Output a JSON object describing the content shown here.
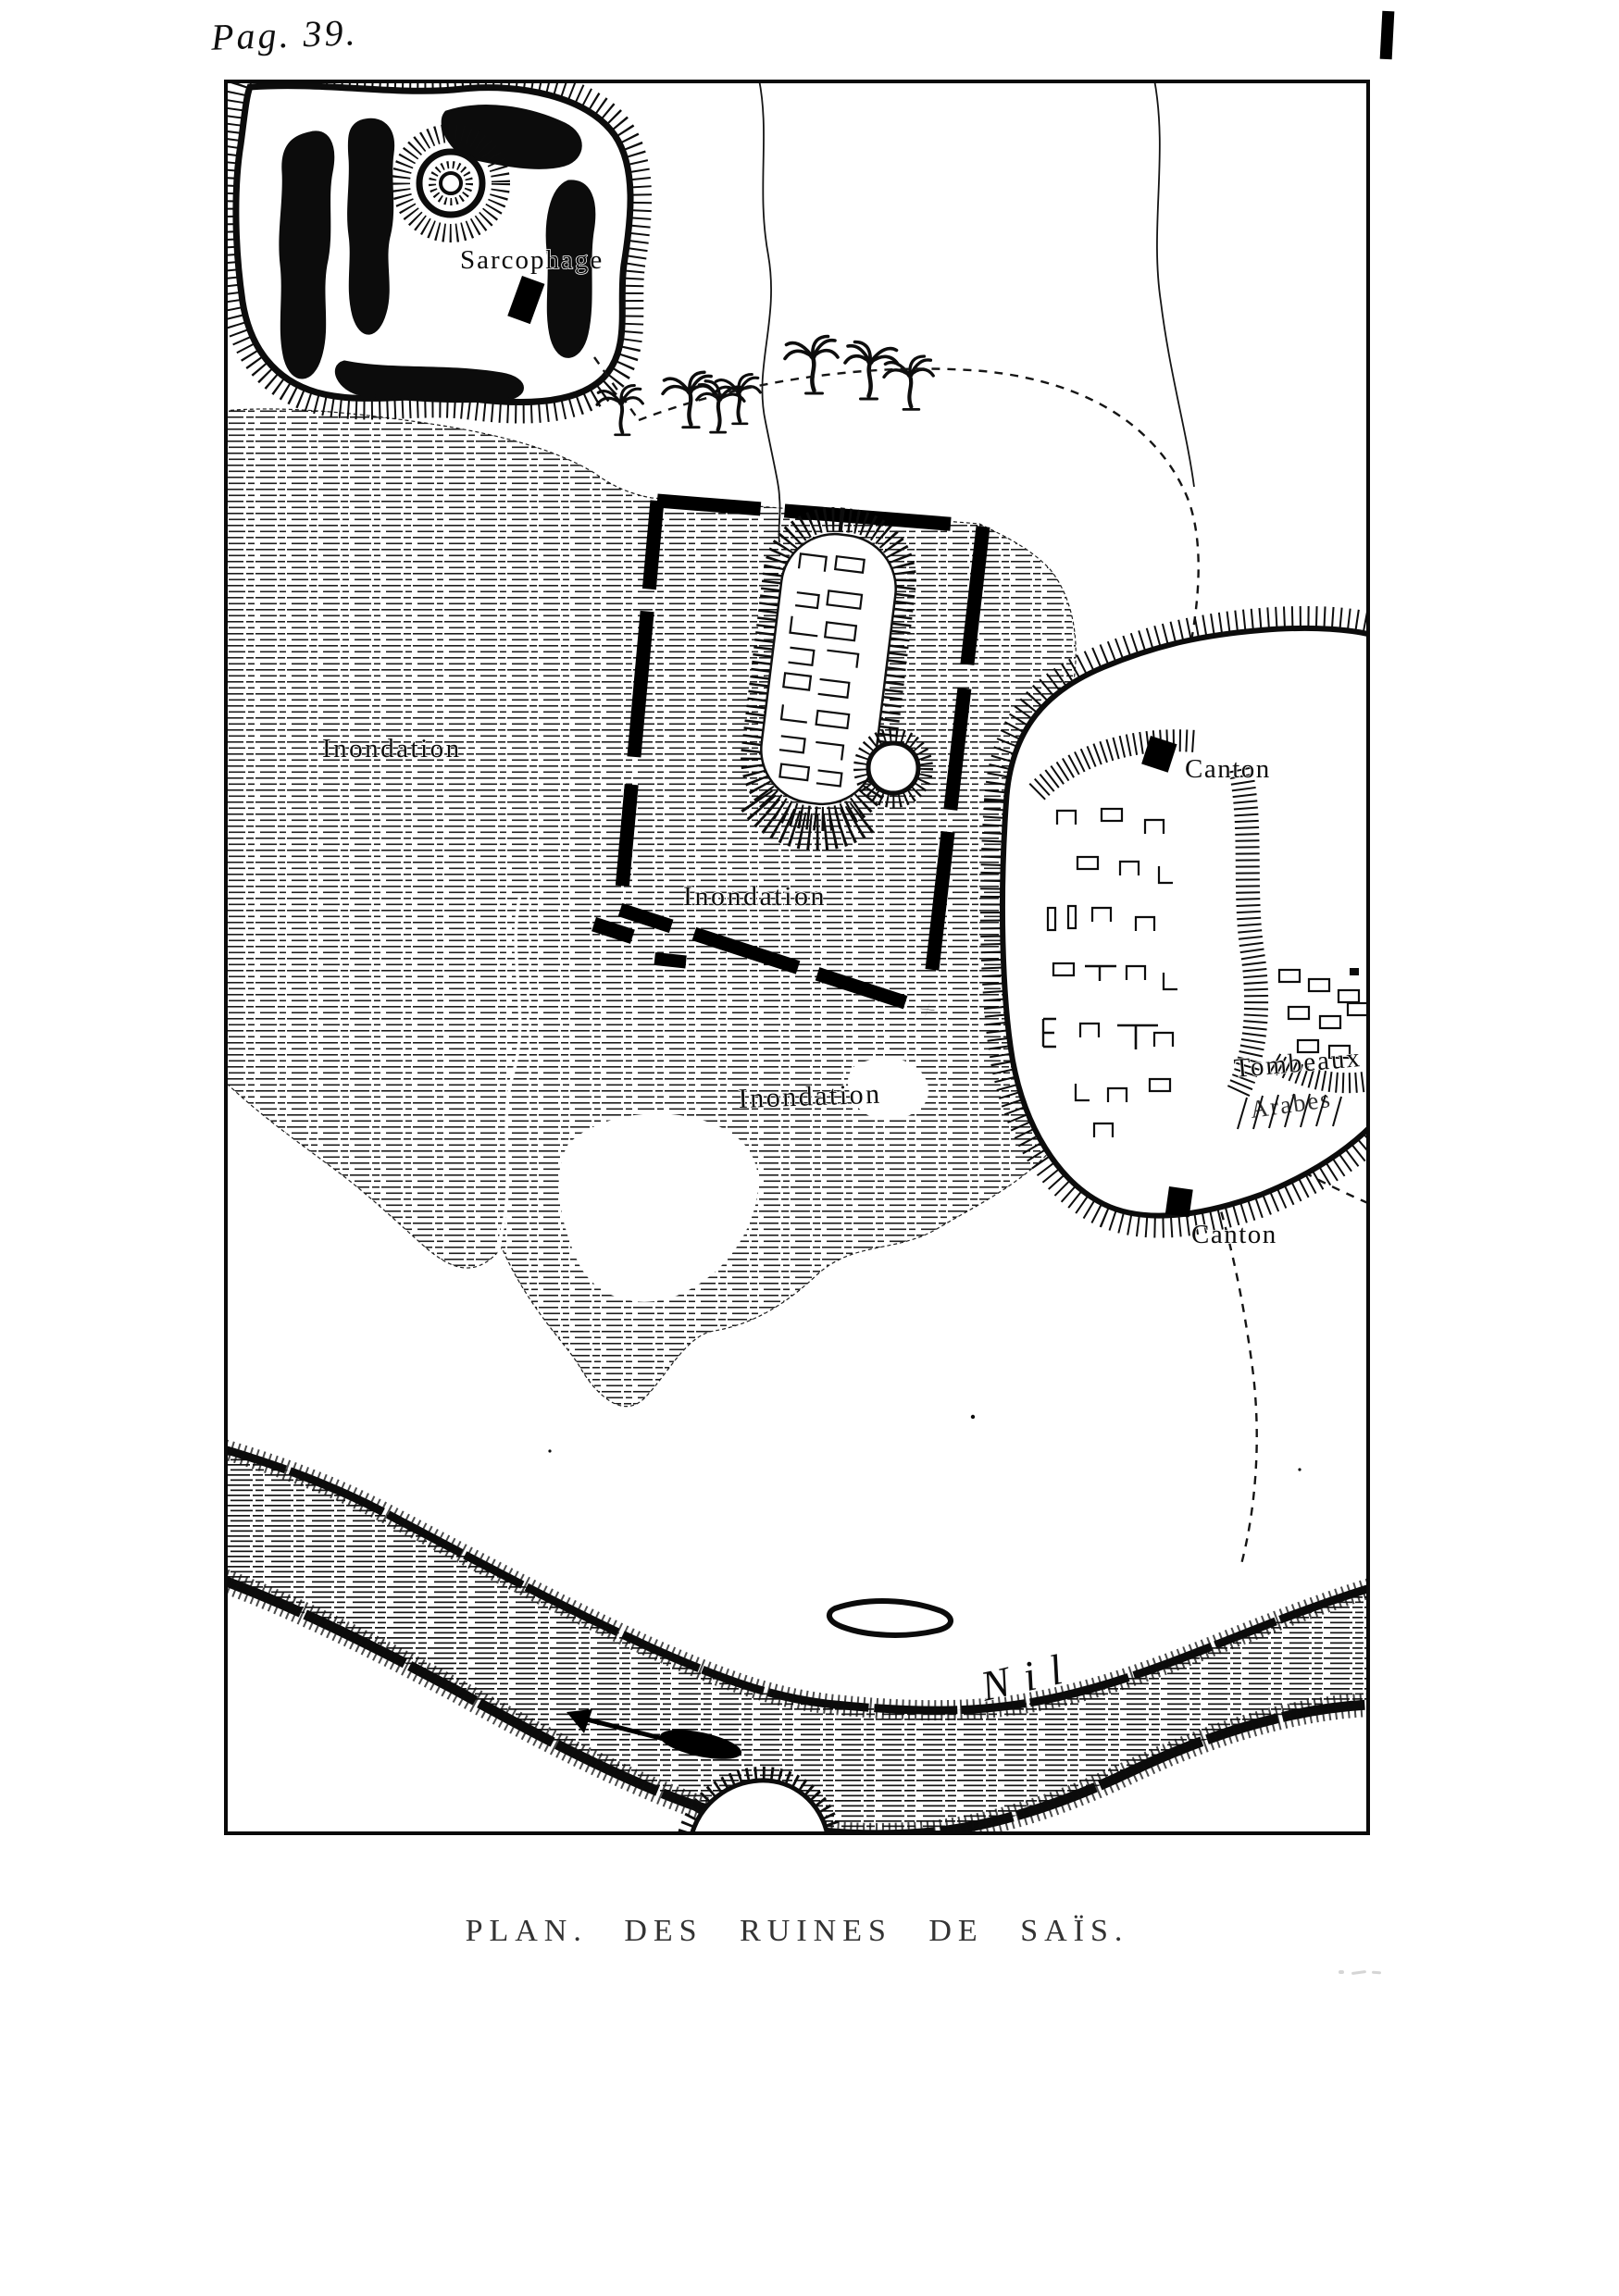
{
  "page": {
    "label": "Pag. 39.",
    "caption": "PLAN. DES RUINES DE SAÏS.",
    "ink_color": "#111111",
    "paper_color": "#ffffff"
  },
  "map": {
    "labels": {
      "sarcophage": "Sarcophage",
      "inondation_west": "Inondation",
      "inondation_center": "Inondation",
      "inondation_south": "Inondation",
      "canton_north": "Canton",
      "canton_south": "Canton",
      "tombeaux": "Tombeaux",
      "arabes": "Arabes",
      "nil": "Nil"
    },
    "symbols": {
      "sarcophagus_marker": "black rectangle",
      "canton_marker": "black square",
      "flow_arrow": "river flow arrow",
      "palm_count": 7
    }
  }
}
